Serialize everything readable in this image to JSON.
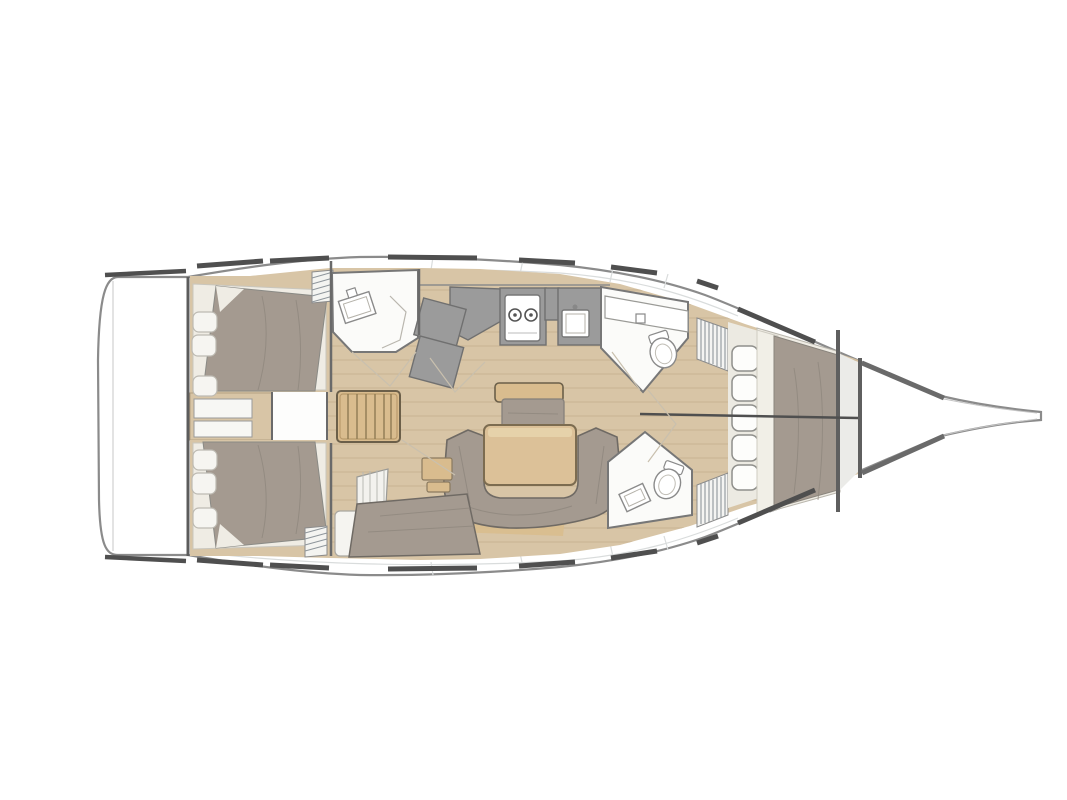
{
  "page": {
    "background": "#ffffff",
    "title": "Sailing yacht interior layout floor plan, bow pointing right"
  },
  "diagram": {
    "type": "boat-floorplan",
    "orientation": "bow-right",
    "rooms": [
      {
        "name": "Swim platform"
      },
      {
        "name": "Port aft double cabin",
        "features": "double berth, 3 pillows"
      },
      {
        "name": "Starboard aft double cabin",
        "features": "double berth, 3 pillows"
      },
      {
        "name": "Companionway steps"
      },
      {
        "name": "Port aft head",
        "features": "washbasin, shower"
      },
      {
        "name": "Galley",
        "features": "2-burner stove, sink, grey counters"
      },
      {
        "name": "Saloon",
        "features": "table, U-shaped settee, centerline bench, chaise seat"
      },
      {
        "name": "Port forward head",
        "features": "washbasin counter, toilet"
      },
      {
        "name": "Starboard forward head",
        "features": "washbasin, toilet"
      },
      {
        "name": "Forward cabin",
        "features": "double V-berth, storage cubbies"
      },
      {
        "name": "Anchor locker"
      },
      {
        "name": "Bowsprit"
      }
    ],
    "fixtures": {
      "stove_burners": 2,
      "toilets": 2,
      "washbasins": 4,
      "forward_cubbies": 5,
      "aft_cabin_pillows_each": 3
    },
    "palette": {
      "bg": "#ffffff",
      "hull_outline": "#8b8b8b",
      "wall": "#6a6a6a",
      "dark_dash": "#4f4f4f",
      "wood_floor": "#d8c5a6",
      "wood_plank_line": "#c7b292",
      "wood_furniture": "#d9bc8e",
      "wood_edge": "#6b5f49",
      "upholstery": "#a49a90",
      "upholstery_line": "#8d857c",
      "cream": "#efece4",
      "pillow": "#f6f5f1",
      "room_white": "#fbfbf9",
      "counter_gray": "#9b9b9b",
      "counter_edge": "#707070",
      "fixture_border": "#8a8a8a",
      "louver": "#8e959b",
      "seam": "#d9dcdc",
      "door_line": "#c9c0ae"
    }
  }
}
